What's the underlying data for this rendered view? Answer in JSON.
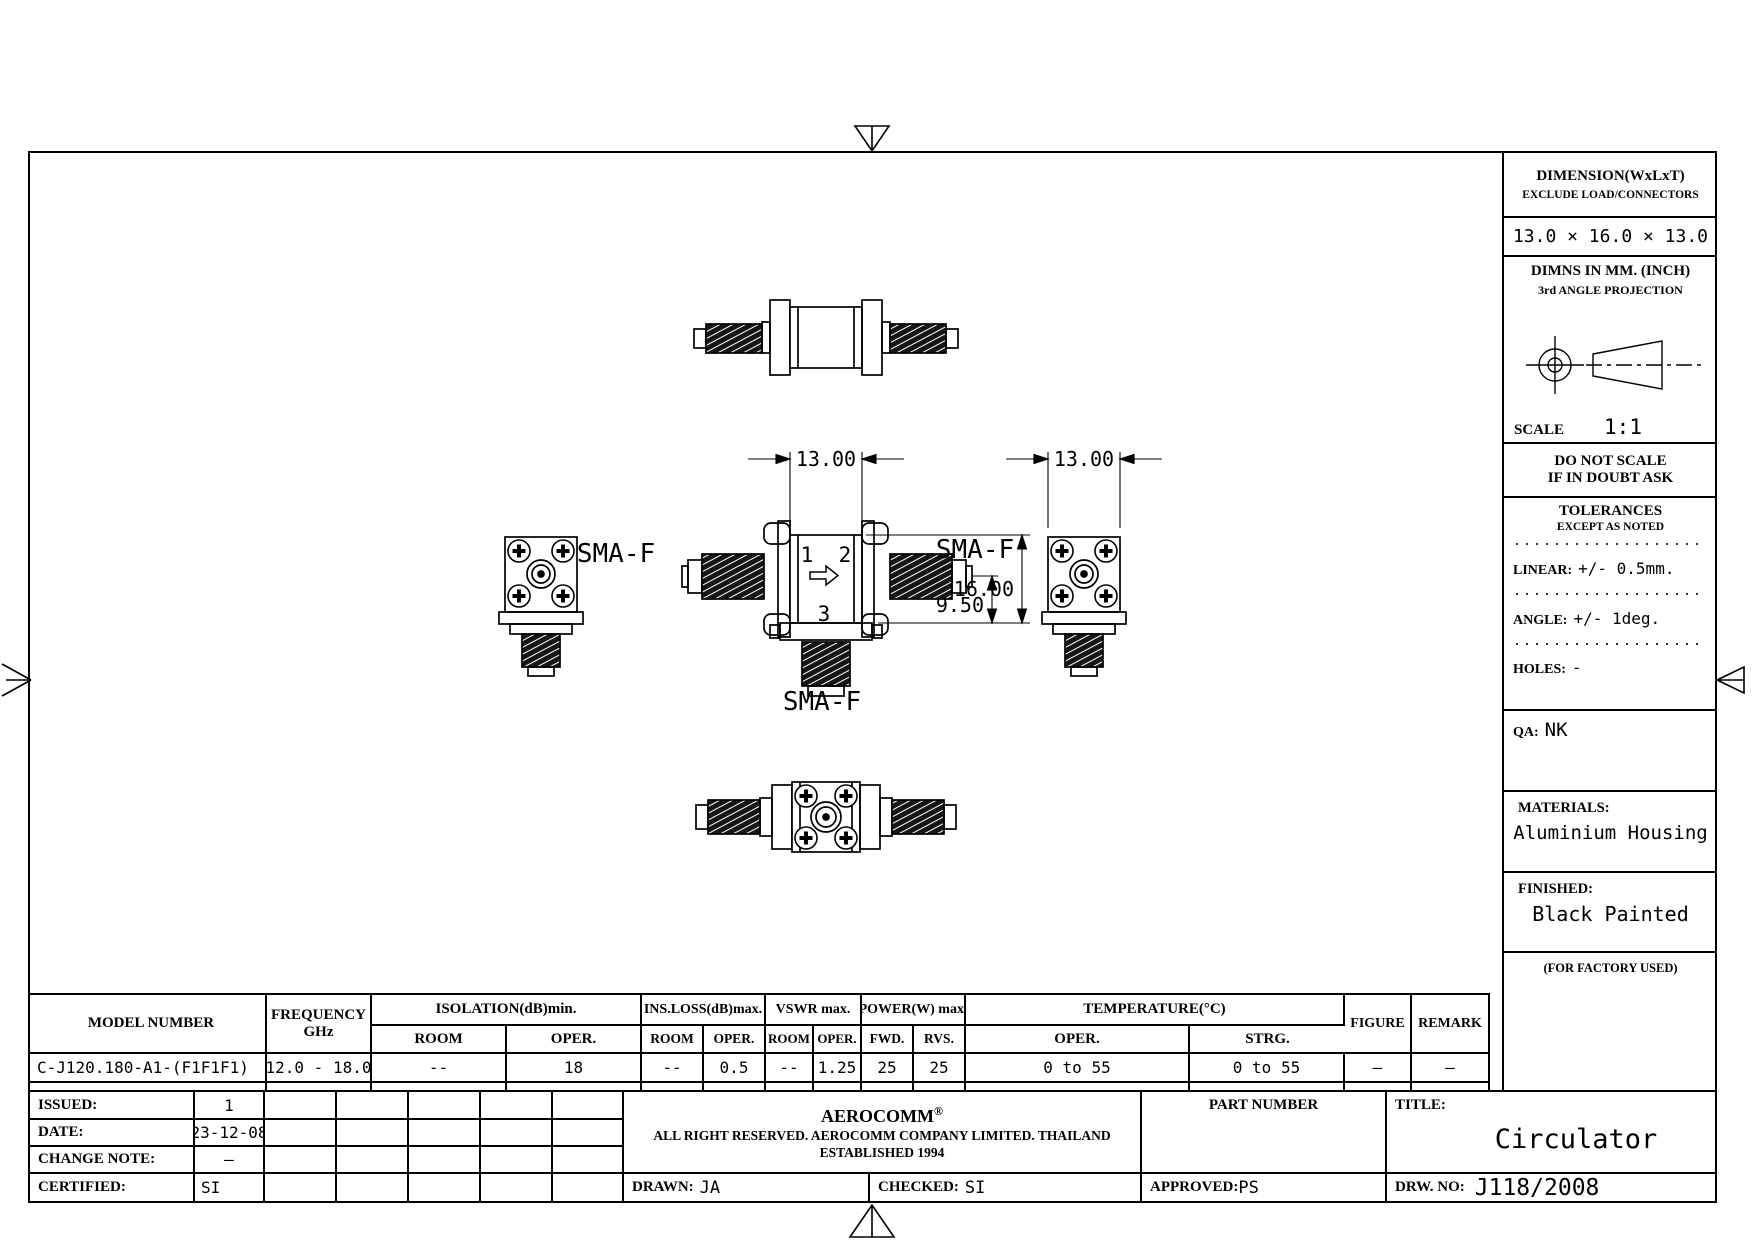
{
  "right_panel": {
    "dimension_title": "DIMENSION(WxLxT)",
    "dimension_note": "EXCLUDE LOAD/CONNECTORS",
    "dimension_value": "13.0 × 16.0 × 13.0",
    "units_note": "DIMNS IN MM. (INCH)",
    "projection_note": "3rd ANGLE PROJECTION",
    "scale_label": "SCALE",
    "scale_value": "1:1",
    "do_not_scale": "DO NOT SCALE",
    "if_in_doubt": "IF IN DOUBT ASK",
    "tolerances_title": "TOLERANCES",
    "tolerances_note": "EXCEPT AS NOTED",
    "linear_label": "LINEAR:",
    "linear_value": "+/- 0.5mm.",
    "angle_label": "ANGLE:",
    "angle_value": "+/- 1deg.",
    "holes_label": "HOLES:",
    "holes_value": "-",
    "qa_label": "QA:",
    "qa_value": "NK",
    "materials_label": "MATERIALS:",
    "materials_value": "Aluminium Housing",
    "finished_label": "FINISHED:",
    "finished_value": "Black Painted",
    "factory_note": "(FOR FACTORY USED)"
  },
  "drawing": {
    "port1": "1",
    "port2": "2",
    "port3": "3",
    "sma_left": "SMA-F",
    "sma_right": "SMA-F",
    "sma_bottom": "SMA-F",
    "dim_width_front": "13.00",
    "dim_width_side": "13.00",
    "dim_height": "16.00",
    "dim_port_offset": "9.50"
  },
  "spec_table": {
    "model_header": "MODEL NUMBER",
    "frequency_header": "FREQUENCY",
    "frequency_unit": "GHz",
    "groups": [
      {
        "label": "ISOLATION(dB)min.",
        "sub1": "ROOM",
        "sub2": "OPER."
      },
      {
        "label": "INS.LOSS(dB)max.",
        "sub1": "ROOM",
        "sub2": "OPER."
      },
      {
        "label": "VSWR max.",
        "sub1": "ROOM",
        "sub2": "OPER."
      },
      {
        "label": "POWER(W) max.",
        "sub1": "FWD.",
        "sub2": "RVS."
      },
      {
        "label": "TEMPERATURE(°C)",
        "sub1": "OPER.",
        "sub2": "STRG."
      }
    ],
    "figure_header": "FIGURE",
    "remark_header": "REMARK",
    "row": {
      "model": "C-J120.180-A1-(F1F1F1)",
      "frequency": "12.0 - 18.0",
      "isolation_room": "--",
      "isolation_oper": "18",
      "ins_loss_room": "--",
      "ins_loss_oper": "0.5",
      "vswr_room": "--",
      "vswr_oper": "1.25",
      "power_fwd": "25",
      "power_rvs": "25",
      "temp_oper": "0 to 55",
      "temp_strg": "0 to 55",
      "figure": "–",
      "remark": "–"
    }
  },
  "title_block": {
    "issued_label": "ISSUED:",
    "issued_value": "1",
    "date_label": "DATE:",
    "date_value": "23-12-08",
    "change_note_label": "CHANGE NOTE:",
    "change_note_value": "–",
    "certified_label": "CERTIFIED:",
    "certified_value": "SI",
    "company_name": "AEROCOMM",
    "company_mark": "®",
    "company_rights": "ALL RIGHT RESERVED. AEROCOMM COMPANY LIMITED. THAILAND",
    "company_established": "ESTABLISHED 1994",
    "drawn_label": "DRAWN:",
    "drawn_value": "JA",
    "checked_label": "CHECKED:",
    "checked_value": "SI",
    "approved_label": "APPROVED:",
    "approved_value": "PS",
    "part_number_label": "PART NUMBER",
    "title_label": "TITLE:",
    "title_value": "Circulator",
    "drw_no_label": "DRW. NO:",
    "drw_no_value": "J118/2008"
  }
}
